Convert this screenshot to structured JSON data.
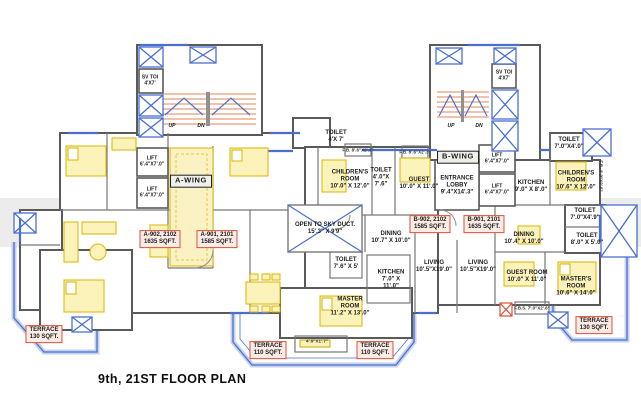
{
  "title": "9th, 21ST FLOOR PLAN",
  "towers": {
    "a": {
      "wing": "A-WING",
      "sv_toi": "SV TOI",
      "sv_toi_dims": "4'X7'",
      "up": "UP",
      "dn": "DN"
    },
    "b": {
      "wing": "B-WING",
      "sv_toi": "SV TOI",
      "sv_toi_dims": "4'X7'",
      "up": "UP",
      "dn": "DN"
    }
  },
  "lifts": {
    "label": "LIFT",
    "dims": "6'.4\"X7'.0\""
  },
  "units": [
    {
      "id": "A-902, 2102",
      "area": "1635 SQFT."
    },
    {
      "id": "A-901, 2101",
      "area": "1585 SQFT."
    },
    {
      "id": "B-902, 2102",
      "area": "1585 SQFT."
    },
    {
      "id": "B-901, 2101",
      "area": "1635 SQFT."
    }
  ],
  "terraces": [
    {
      "name": "TERRACE",
      "area": "130 SQFT."
    },
    {
      "name": "TERRACE",
      "area": "110 SQFT."
    },
    {
      "name": "TERRACE",
      "area": "110 SQFT."
    },
    {
      "name": "TERRACE",
      "area": "130 SQFT."
    }
  ],
  "rooms": [
    {
      "name": "TOILET",
      "dims": "4'X 7'"
    },
    {
      "name": "CHILDREN'S\nROOM",
      "dims": "10'.0\" X 12'.0\""
    },
    {
      "name": "TOILET",
      "dims": "4'.0\"X\n7'.6\""
    },
    {
      "name": "GUEST",
      "dims": "10'.0\" X 11'.0\""
    },
    {
      "name": "OPEN TO SKY DUCT.",
      "dims": "15'.3\" X 9'9\""
    },
    {
      "name": "TOILET",
      "dims": "7'.6\" X 5'"
    },
    {
      "name": "MASTER\nROOM",
      "dims": "11'.2\" X 13'.0\""
    },
    {
      "name": "DINING",
      "dims": "10'.7\" X 10'.0\""
    },
    {
      "name": "KITCHEN",
      "dims": "7'.0\" X\n11'.0\""
    },
    {
      "name": "LIVING",
      "dims": "10'.5\"X19'.0\""
    },
    {
      "name": "LIVING",
      "dims": "10'.5\"X19'.0\""
    },
    {
      "name": "ENTRANCE\nLOBBY",
      "dims": "9'.4\"X14'.3\""
    },
    {
      "name": "KITCHEN",
      "dims": "9'.0\" X 8'.0\""
    },
    {
      "name": "CHILDREN'S\nROOM",
      "dims": "10'.6\" X 12'.0\""
    },
    {
      "name": "TOILET",
      "dims": "7'.0\"X4'.0\""
    },
    {
      "name": "TOILET",
      "dims": "7'.0\"X4'.9\""
    },
    {
      "name": "TOILET",
      "dims": "8'.0\" X 5'.0\""
    },
    {
      "name": "DINING",
      "dims": "10'.4\" X 10'.0\""
    },
    {
      "name": "GUEST ROOM",
      "dims": "10'.0\" X 11'.0\""
    },
    {
      "name": "MASTER'S\nROOM",
      "dims": "10'.6\" X 14'.0\""
    }
  ],
  "small_labels": [
    {
      "text": "F.B. 8'.6\"X2'.3\""
    },
    {
      "text": "F.B. 8'.6\"X2'.3\""
    },
    {
      "text": "F.B.S. 7'.0\"X2'.6\""
    },
    {
      "text": "F.B. 4'.0\"X2'.6\""
    },
    {
      "text": "4'.9\"X1'.7\""
    }
  ],
  "colors": {
    "wall_blue": "#4a6fd0",
    "wall_gray": "#5a5a5a",
    "stair_orange": "#e0855a",
    "furniture_yellow": "#d8b400",
    "label_red": "#dd5138"
  }
}
